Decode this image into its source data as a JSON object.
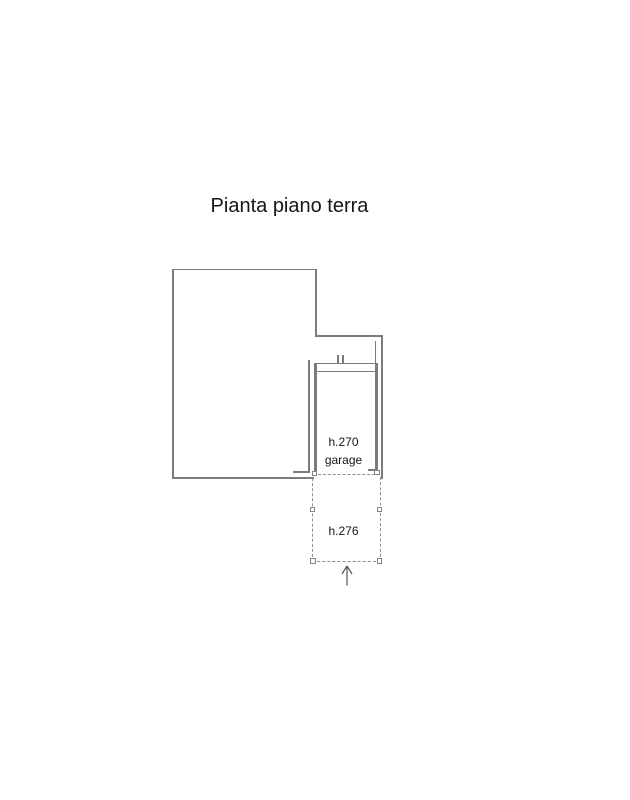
{
  "title": "Pianta piano terra",
  "plan": {
    "garage": {
      "height_label": "h.270",
      "room_label": "garage"
    },
    "carport": {
      "height_label": "h.276"
    },
    "entrance": {
      "icon": "up-arrow"
    }
  },
  "colors": {
    "background": "#ffffff",
    "wall_line": "#7c7c7c",
    "dashed_line": "#8e8e8e",
    "text": "#161616",
    "arrow": "#565656"
  }
}
